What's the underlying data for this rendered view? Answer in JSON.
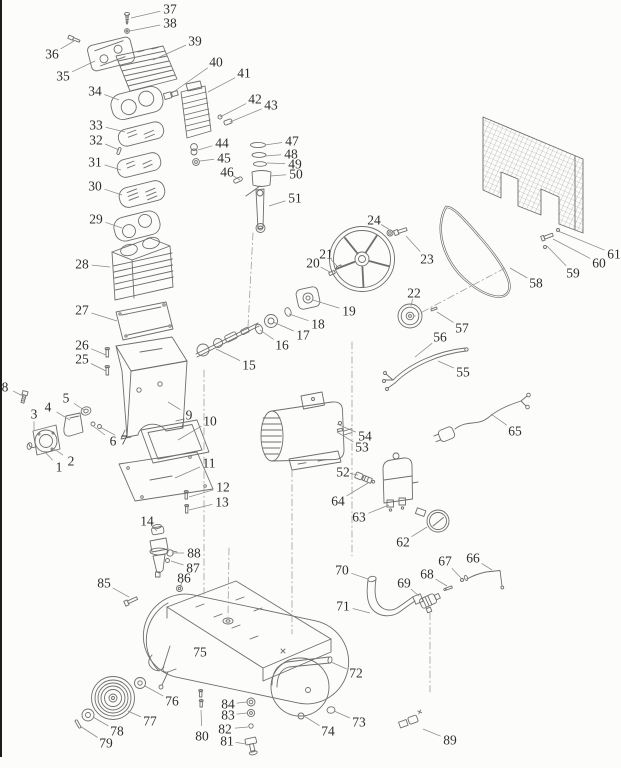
{
  "figure": {
    "kind": "exploded-parts-diagram",
    "subject": "air compressor",
    "part_count": 89
  },
  "canvas": {
    "width": 621,
    "height": 768,
    "background": "#fcfcfb",
    "ink": "#6e6e6e",
    "label_color": "#2e2e2e",
    "leader_color": "#8a8a8a",
    "dash_color": "#9f9f9f"
  },
  "parts": [
    {
      "num": "1",
      "x": 59,
      "y": 467,
      "lx": 45,
      "ly": 452
    },
    {
      "num": "2",
      "x": 71,
      "y": 461,
      "lx": 53,
      "ly": 448
    },
    {
      "num": "3",
      "x": 34,
      "y": 414,
      "lx": 34,
      "ly": 430
    },
    {
      "num": "4",
      "x": 48,
      "y": 407,
      "lx": 70,
      "ly": 420
    },
    {
      "num": "5",
      "x": 66,
      "y": 398,
      "lx": 84,
      "ly": 410
    },
    {
      "num": "6",
      "x": 113,
      "y": 441,
      "lx": 93,
      "ly": 426
    },
    {
      "num": "7",
      "x": 124,
      "y": 440,
      "lx": 100,
      "ly": 427
    },
    {
      "num": "8",
      "x": 5,
      "y": 387,
      "lx": 23,
      "ly": 396
    },
    {
      "num": "9",
      "x": 189,
      "y": 415,
      "lx": 168,
      "ly": 402
    },
    {
      "num": "10",
      "x": 210,
      "y": 421,
      "lx": 178,
      "ly": 440
    },
    {
      "num": "11",
      "x": 209,
      "y": 463,
      "lx": 175,
      "ly": 478
    },
    {
      "num": "12",
      "x": 223,
      "y": 487,
      "lx": 189,
      "ly": 497
    },
    {
      "num": "13",
      "x": 222,
      "y": 502,
      "lx": 189,
      "ly": 510
    },
    {
      "num": "14",
      "x": 147,
      "y": 521,
      "lx": 157,
      "ly": 531
    },
    {
      "num": "15",
      "x": 249,
      "y": 365,
      "lx": 216,
      "ly": 349
    },
    {
      "num": "16",
      "x": 282,
      "y": 345,
      "lx": 260,
      "ly": 330
    },
    {
      "num": "17",
      "x": 303,
      "y": 335,
      "lx": 273,
      "ly": 322
    },
    {
      "num": "18",
      "x": 318,
      "y": 324,
      "lx": 289,
      "ly": 314
    },
    {
      "num": "19",
      "x": 349,
      "y": 311,
      "lx": 313,
      "ly": 300
    },
    {
      "num": "20",
      "x": 313,
      "y": 263,
      "lx": 330,
      "ly": 272
    },
    {
      "num": "21",
      "x": 326,
      "y": 254,
      "lx": 337,
      "ly": 266
    },
    {
      "num": "22",
      "x": 414,
      "y": 293,
      "lx": 411,
      "ly": 306
    },
    {
      "num": "23",
      "x": 427,
      "y": 259,
      "lx": 406,
      "ly": 236
    },
    {
      "num": "24",
      "x": 374,
      "y": 220,
      "lx": 390,
      "ly": 230
    },
    {
      "num": "25",
      "x": 82,
      "y": 359,
      "lx": 106,
      "ly": 371
    },
    {
      "num": "26",
      "x": 82,
      "y": 345,
      "lx": 106,
      "ly": 355
    },
    {
      "num": "27",
      "x": 82,
      "y": 310,
      "lx": 117,
      "ly": 321
    },
    {
      "num": "28",
      "x": 82,
      "y": 264,
      "lx": 110,
      "ly": 267
    },
    {
      "num": "29",
      "x": 96,
      "y": 219,
      "lx": 122,
      "ly": 228
    },
    {
      "num": "30",
      "x": 95,
      "y": 186,
      "lx": 122,
      "ly": 195
    },
    {
      "num": "31",
      "x": 95,
      "y": 162,
      "lx": 121,
      "ly": 170
    },
    {
      "num": "32",
      "x": 96,
      "y": 140,
      "lx": 119,
      "ly": 150
    },
    {
      "num": "33",
      "x": 96,
      "y": 125,
      "lx": 125,
      "ly": 132
    },
    {
      "num": "34",
      "x": 95,
      "y": 91,
      "lx": 119,
      "ly": 100
    },
    {
      "num": "35",
      "x": 63,
      "y": 76,
      "lx": 95,
      "ly": 61
    },
    {
      "num": "36",
      "x": 52,
      "y": 54,
      "lx": 74,
      "ly": 41
    },
    {
      "num": "37",
      "x": 170,
      "y": 9,
      "lx": 131,
      "ly": 18
    },
    {
      "num": "38",
      "x": 170,
      "y": 23,
      "lx": 130,
      "ly": 31
    },
    {
      "num": "39",
      "x": 195,
      "y": 41,
      "lx": 153,
      "ly": 60
    },
    {
      "num": "40",
      "x": 216,
      "y": 62,
      "lx": 172,
      "ly": 93
    },
    {
      "num": "41",
      "x": 244,
      "y": 73,
      "lx": 208,
      "ly": 92
    },
    {
      "num": "42",
      "x": 255,
      "y": 99,
      "lx": 220,
      "ly": 117
    },
    {
      "num": "43",
      "x": 271,
      "y": 105,
      "lx": 230,
      "ly": 122
    },
    {
      "num": "44",
      "x": 222,
      "y": 143,
      "lx": 198,
      "ly": 150
    },
    {
      "num": "45",
      "x": 224,
      "y": 158,
      "lx": 200,
      "ly": 161
    },
    {
      "num": "46",
      "x": 227,
      "y": 172,
      "lx": 240,
      "ly": 180
    },
    {
      "num": "47",
      "x": 292,
      "y": 141,
      "lx": 265,
      "ly": 145
    },
    {
      "num": "48",
      "x": 291,
      "y": 154,
      "lx": 265,
      "ly": 156
    },
    {
      "num": "49",
      "x": 295,
      "y": 164,
      "lx": 267,
      "ly": 163
    },
    {
      "num": "50",
      "x": 296,
      "y": 174,
      "lx": 270,
      "ly": 176
    },
    {
      "num": "51",
      "x": 295,
      "y": 198,
      "lx": 269,
      "ly": 206
    },
    {
      "num": "52",
      "x": 343,
      "y": 472,
      "lx": 358,
      "ly": 475
    },
    {
      "num": "53",
      "x": 362,
      "y": 447,
      "lx": 337,
      "ly": 432
    },
    {
      "num": "54",
      "x": 365,
      "y": 436,
      "lx": 337,
      "ly": 424
    },
    {
      "num": "55",
      "x": 463,
      "y": 372,
      "lx": 438,
      "ly": 361
    },
    {
      "num": "56",
      "x": 440,
      "y": 337,
      "lx": 415,
      "ly": 357
    },
    {
      "num": "57",
      "x": 462,
      "y": 328,
      "lx": 437,
      "ly": 312
    },
    {
      "num": "58",
      "x": 536,
      "y": 283,
      "lx": 510,
      "ly": 268
    },
    {
      "num": "59",
      "x": 573,
      "y": 273,
      "lx": 547,
      "ly": 246
    },
    {
      "num": "60",
      "x": 599,
      "y": 263,
      "lx": 553,
      "ly": 239
    },
    {
      "num": "61",
      "x": 614,
      "y": 254,
      "lx": 558,
      "ly": 231
    },
    {
      "num": "62",
      "x": 403,
      "y": 542,
      "lx": 427,
      "ly": 527
    },
    {
      "num": "63",
      "x": 359,
      "y": 517,
      "lx": 389,
      "ly": 505
    },
    {
      "num": "64",
      "x": 338,
      "y": 501,
      "lx": 368,
      "ly": 483
    },
    {
      "num": "65",
      "x": 515,
      "y": 431,
      "lx": 491,
      "ly": 414
    },
    {
      "num": "66",
      "x": 473,
      "y": 558,
      "lx": 492,
      "ly": 570
    },
    {
      "num": "67",
      "x": 445,
      "y": 561,
      "lx": 461,
      "ly": 578
    },
    {
      "num": "68",
      "x": 427,
      "y": 574,
      "lx": 447,
      "ly": 586
    },
    {
      "num": "69",
      "x": 404,
      "y": 583,
      "lx": 419,
      "ly": 596
    },
    {
      "num": "70",
      "x": 342,
      "y": 570,
      "lx": 368,
      "ly": 579
    },
    {
      "num": "71",
      "x": 343,
      "y": 606,
      "lx": 370,
      "ly": 613
    },
    {
      "num": "72",
      "x": 356,
      "y": 673,
      "lx": 331,
      "ly": 662
    },
    {
      "num": "73",
      "x": 359,
      "y": 722,
      "lx": 334,
      "ly": 711
    },
    {
      "num": "74",
      "x": 328,
      "y": 731,
      "lx": 304,
      "ly": 716
    },
    {
      "num": "75",
      "x": 200,
      "y": 652,
      "lx": null,
      "ly": null
    },
    {
      "num": "76",
      "x": 172,
      "y": 701,
      "lx": 145,
      "ly": 686
    },
    {
      "num": "77",
      "x": 150,
      "y": 721,
      "lx": 128,
      "ly": 711
    },
    {
      "num": "78",
      "x": 117,
      "y": 731,
      "lx": 93,
      "ly": 717
    },
    {
      "num": "79",
      "x": 106,
      "y": 743,
      "lx": 80,
      "ly": 726
    },
    {
      "num": "80",
      "x": 202,
      "y": 736,
      "lx": 201,
      "ly": 710
    },
    {
      "num": "81",
      "x": 227,
      "y": 741,
      "lx": 246,
      "ly": 744
    },
    {
      "num": "82",
      "x": 225,
      "y": 729,
      "lx": 248,
      "ly": 727
    },
    {
      "num": "83",
      "x": 228,
      "y": 715,
      "lx": 247,
      "ly": 713
    },
    {
      "num": "84",
      "x": 228,
      "y": 704,
      "lx": 247,
      "ly": 702
    },
    {
      "num": "85",
      "x": 104,
      "y": 583,
      "lx": 129,
      "ly": 597
    },
    {
      "num": "86",
      "x": 184,
      "y": 578,
      "lx": 180,
      "ly": 587
    },
    {
      "num": "87",
      "x": 193,
      "y": 568,
      "lx": 171,
      "ly": 561
    },
    {
      "num": "88",
      "x": 194,
      "y": 553,
      "lx": 172,
      "ly": 553
    },
    {
      "num": "89",
      "x": 450,
      "y": 740,
      "lx": 423,
      "ly": 729
    }
  ]
}
